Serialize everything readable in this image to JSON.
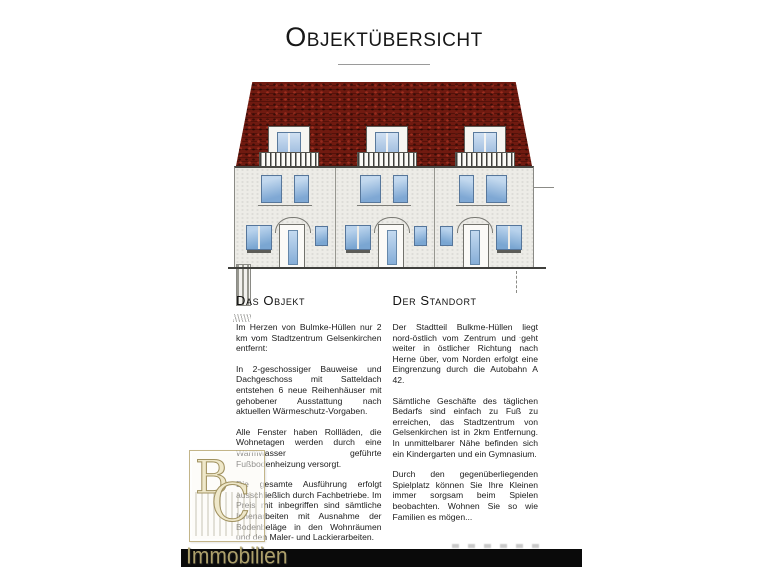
{
  "document": {
    "title": "Objektübersicht"
  },
  "illustration": {
    "type": "architectural front elevation drawing",
    "units": 3,
    "features": [
      "red tiled mansard roof",
      "three dormer windows with balustrades",
      "arched entrance doors",
      "blue glazed windows"
    ]
  },
  "sections": {
    "left": {
      "heading": "Das Objekt",
      "paragraphs": [
        "Im Herzen von Bulmke-Hüllen nur 2 km vom Stadtzentrum Gelsenkirchen entfernt:",
        "In 2-geschossiger Bauweise und Dachgeschoss mit Satteldach entstehen 6 neue Reihenhäuser mit gehobener Ausstattung nach aktuellen Wärmeschutz-Vorgaben.",
        "Alle Fenster haben Rollläden, die Wohnetagen werden durch eine Warmwasser geführte Fußbodenheizung versorgt.",
        "Die gesamte Ausführung erfolgt ausschließlich durch Fachbetriebe. Im Preis mit inbegriffen sind sämtliche Innenarbeiten mit Ausnahme der Bodenbeläge in den Wohnräumen und den Maler- und Lackierarbeiten."
      ]
    },
    "right": {
      "heading": "Der Standort",
      "paragraphs": [
        "Der Stadtteil Bulkme-Hüllen liegt nord-östlich vom Zentrum und geht weiter in östlicher Richtung nach Herne über, vom Norden erfolgt eine Eingrenzung durch die Autobahn A 42.",
        "Sämtliche Geschäfte des täglichen Bedarfs sind einfach zu Fuß zu erreichen, das Stadtzentrum von Gelsenkirchen ist in 2km Entfernung. In unmittelbarer Nähe befinden sich ein Kindergarten und ein Gymnasium.",
        "Durch den gegenüberliegenden Spielplatz können Sie Ihre Kleinen immer sorgsam beim Spielen beobachten. Wohnen Sie so wie Familien es mögen..."
      ]
    }
  },
  "watermark": {
    "letters": [
      "B",
      "C"
    ],
    "label": "Immobilien"
  },
  "colors": {
    "roof_red": "#701a10",
    "facade": "#edece7",
    "window_blue": "#8fb1d8",
    "logo_gold": "#b5a770",
    "redaction_bar": "#0a0a0a"
  }
}
